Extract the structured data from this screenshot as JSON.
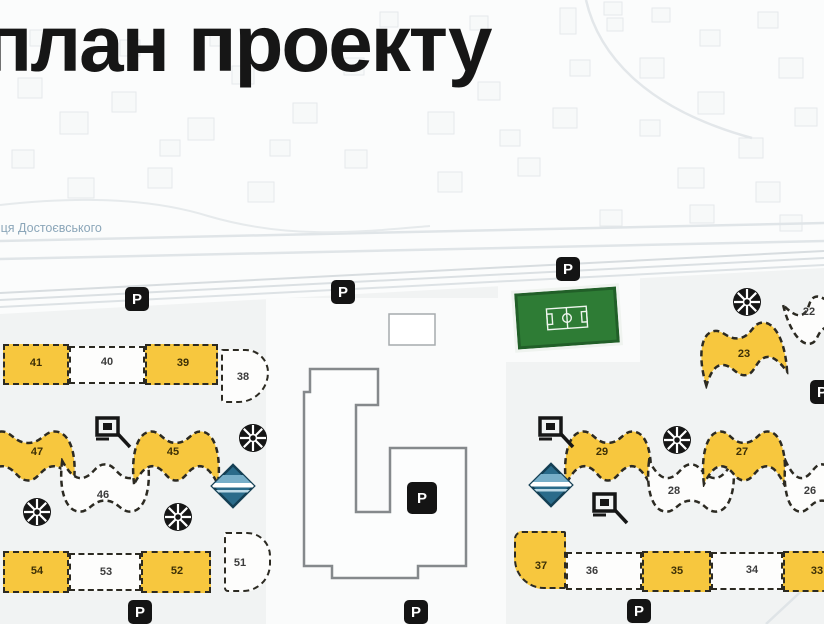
{
  "title": "план проекту",
  "street_label": "вулиця Достоєвського",
  "colors": {
    "background_top": "#fbfcfc",
    "background_site": "#f1f3f3",
    "building_yellow": "#f7c73e",
    "building_white": "#fdfdfc",
    "building_outline": "#2c2a22",
    "school_green": "#2e7c35",
    "kindergarten_blue": "#2a6b8a",
    "icon_black": "#161616",
    "central_building_stroke": "#85898c",
    "street_text": "#8ba6b9"
  },
  "buildings": [
    {
      "num": "41",
      "shape": "rect",
      "fill": "yellow",
      "x": 3,
      "y": 344,
      "w": 66,
      "h": 41,
      "nx": 36,
      "ny": 363
    },
    {
      "num": "40",
      "shape": "rect",
      "fill": "white",
      "x": 69,
      "y": 346,
      "w": 76,
      "h": 38,
      "nx": 107,
      "ny": 362
    },
    {
      "num": "39",
      "shape": "rect",
      "fill": "yellow",
      "x": 145,
      "y": 344,
      "w": 73,
      "h": 41,
      "nx": 183,
      "ny": 363
    },
    {
      "num": "38",
      "shape": "blob",
      "fill": "white",
      "x": 221,
      "y": 349,
      "w": 48,
      "h": 54,
      "radius": "2px 26px 34px 4px",
      "nx": 243,
      "ny": 377
    },
    {
      "num": "47",
      "shape": "wave",
      "fill": "yellow",
      "x": -22,
      "y": 427,
      "w": 100,
      "h": 60,
      "nx": 37,
      "ny": 452
    },
    {
      "num": "46",
      "shape": "waveDown",
      "fill": "white",
      "x": 58,
      "y": 458,
      "w": 94,
      "h": 58,
      "nx": 103,
      "ny": 495
    },
    {
      "num": "45",
      "shape": "wave",
      "fill": "yellow",
      "x": 130,
      "y": 427,
      "w": 92,
      "h": 60,
      "nx": 173,
      "ny": 452
    },
    {
      "num": "54",
      "shape": "rect",
      "fill": "yellow",
      "x": 3,
      "y": 551,
      "w": 66,
      "h": 42,
      "nx": 37,
      "ny": 571
    },
    {
      "num": "53",
      "shape": "rect",
      "fill": "white",
      "x": 69,
      "y": 553,
      "w": 72,
      "h": 38,
      "nx": 106,
      "ny": 572
    },
    {
      "num": "52",
      "shape": "rect",
      "fill": "yellow",
      "x": 141,
      "y": 551,
      "w": 70,
      "h": 42,
      "nx": 177,
      "ny": 571
    },
    {
      "num": "51",
      "shape": "blob",
      "fill": "white",
      "x": 224,
      "y": 532,
      "w": 47,
      "h": 60,
      "radius": "2px 24px 28px 4px",
      "nx": 240,
      "ny": 563
    },
    {
      "num": "22",
      "shape": "waveDown",
      "fill": "white",
      "x": 786,
      "y": 290,
      "w": 72,
      "h": 52,
      "rot": -20,
      "nx": 809,
      "ny": 312
    },
    {
      "num": "23",
      "shape": "wave",
      "fill": "yellow",
      "x": 697,
      "y": 322,
      "w": 90,
      "h": 60,
      "rot": -10,
      "nx": 744,
      "ny": 354
    },
    {
      "num": "29",
      "shape": "wave",
      "fill": "yellow",
      "x": 562,
      "y": 427,
      "w": 92,
      "h": 60,
      "nx": 602,
      "ny": 452
    },
    {
      "num": "28",
      "shape": "waveDown",
      "fill": "white",
      "x": 645,
      "y": 458,
      "w": 92,
      "h": 58,
      "nx": 674,
      "ny": 491
    },
    {
      "num": "27",
      "shape": "wave",
      "fill": "yellow",
      "x": 700,
      "y": 427,
      "w": 88,
      "h": 60,
      "nx": 742,
      "ny": 452
    },
    {
      "num": "26",
      "shape": "waveDown",
      "fill": "white",
      "x": 782,
      "y": 458,
      "w": 80,
      "h": 58,
      "nx": 810,
      "ny": 491
    },
    {
      "num": "37",
      "shape": "blob",
      "fill": "yellow",
      "x": 514,
      "y": 531,
      "w": 52,
      "h": 58,
      "radius": "8px 2px 2px 30px",
      "nx": 541,
      "ny": 566
    },
    {
      "num": "36",
      "shape": "rect",
      "fill": "white",
      "x": 566,
      "y": 552,
      "w": 76,
      "h": 38,
      "nx": 592,
      "ny": 571
    },
    {
      "num": "35",
      "shape": "rect",
      "fill": "yellow",
      "x": 642,
      "y": 551,
      "w": 69,
      "h": 41,
      "nx": 677,
      "ny": 571
    },
    {
      "num": "34",
      "shape": "rect",
      "fill": "white",
      "x": 711,
      "y": 552,
      "w": 72,
      "h": 38,
      "nx": 752,
      "ny": 570
    },
    {
      "num": "33",
      "shape": "rect",
      "fill": "yellow",
      "x": 783,
      "y": 551,
      "w": 55,
      "h": 41,
      "nx": 817,
      "ny": 571
    }
  ],
  "icons": {
    "parking_label": "P",
    "parking": [
      {
        "x": 125,
        "y": 287
      },
      {
        "x": 331,
        "y": 280
      },
      {
        "x": 556,
        "y": 257
      },
      {
        "x": 810,
        "y": 380
      },
      {
        "x": 128,
        "y": 600
      },
      {
        "x": 404,
        "y": 600
      },
      {
        "x": 627,
        "y": 599
      }
    ],
    "parking_central": {
      "x": 407,
      "y": 482,
      "w": 30,
      "h": 32
    },
    "playground": [
      {
        "cx": 37,
        "cy": 512
      },
      {
        "cx": 178,
        "cy": 517
      },
      {
        "cx": 253,
        "cy": 438
      },
      {
        "cx": 677,
        "cy": 440
      },
      {
        "cx": 747,
        "cy": 302
      }
    ],
    "sport": [
      {
        "x": 95,
        "y": 416
      },
      {
        "x": 538,
        "y": 416
      },
      {
        "x": 592,
        "y": 492
      }
    ],
    "kindergarten": [
      {
        "cx": 233,
        "cy": 486
      },
      {
        "cx": 551,
        "cy": 485
      }
    ]
  },
  "school": {
    "x": 516,
    "y": 290,
    "w": 102,
    "h": 56,
    "rot": -4
  },
  "central_building": {
    "path": "M310,369 L378,369 L378,405 L356,405 L356,512 L390,512 L390,448 L466,448 L466,566 L418,566 L418,578 L332,578 L332,566 L304,566 L304,392 L310,392 Z"
  },
  "bg": {
    "lower_poly": "0,314 824,268 824,624 0,624",
    "patches": [
      {
        "x": 266,
        "y": 298,
        "w": 240,
        "h": 326
      },
      {
        "x": 498,
        "y": 276,
        "w": 142,
        "h": 86
      }
    ],
    "outline_rect": {
      "x": 389,
      "y": 314,
      "w": 46,
      "h": 31
    },
    "roads": [
      {
        "x1": 0,
        "y1": 241,
        "x2": 824,
        "y2": 223,
        "w": 2.5,
        "c": "#e0e5e8"
      },
      {
        "x1": 0,
        "y1": 259,
        "x2": 824,
        "y2": 241,
        "w": 2.5,
        "c": "#e0e5e8"
      },
      {
        "x1": 0,
        "y1": 293,
        "x2": 824,
        "y2": 251,
        "w": 2,
        "c": "#d8dde0"
      },
      {
        "x1": 0,
        "y1": 300,
        "x2": 824,
        "y2": 258,
        "w": 2,
        "c": "#dbe0e3"
      },
      {
        "x1": 0,
        "y1": 307,
        "x2": 824,
        "y2": 265,
        "w": 2,
        "c": "#dde2e5"
      },
      {
        "x1": 766,
        "y1": 624,
        "x2": 824,
        "y2": 570,
        "w": 2.5,
        "c": "#dfe4e7"
      },
      {
        "d": "M586,0 C598,52 642,108 752,138",
        "w": 2.5,
        "c": "#e3e7ea"
      },
      {
        "d": "M0,205 C80,196 150,198 208,216 C290,240 360,232 430,226",
        "w": 2,
        "c": "#e6eaec"
      }
    ],
    "parcels": [
      [
        18,
        78,
        24,
        20
      ],
      [
        60,
        112,
        28,
        22
      ],
      [
        112,
        92,
        24,
        20
      ],
      [
        188,
        118,
        26,
        22
      ],
      [
        232,
        66,
        22,
        18
      ],
      [
        293,
        103,
        24,
        20
      ],
      [
        344,
        58,
        20,
        17
      ],
      [
        380,
        12,
        18,
        15
      ],
      [
        428,
        112,
        26,
        22
      ],
      [
        478,
        82,
        22,
        18
      ],
      [
        470,
        16,
        18,
        14
      ],
      [
        553,
        108,
        24,
        20
      ],
      [
        560,
        8,
        16,
        26
      ],
      [
        604,
        2,
        18,
        13
      ],
      [
        607,
        18,
        16,
        13
      ],
      [
        640,
        58,
        24,
        20
      ],
      [
        652,
        8,
        18,
        14
      ],
      [
        698,
        92,
        26,
        22
      ],
      [
        739,
        138,
        24,
        20
      ],
      [
        758,
        12,
        20,
        16
      ],
      [
        779,
        58,
        24,
        20
      ],
      [
        795,
        108,
        22,
        18
      ],
      [
        68,
        178,
        26,
        20
      ],
      [
        148,
        168,
        24,
        20
      ],
      [
        248,
        182,
        26,
        20
      ],
      [
        438,
        172,
        24,
        20
      ],
      [
        518,
        158,
        22,
        18
      ],
      [
        678,
        168,
        26,
        20
      ],
      [
        756,
        182,
        24,
        20
      ],
      [
        12,
        150,
        22,
        18
      ],
      [
        345,
        150,
        22,
        18
      ],
      [
        210,
        30,
        20,
        16
      ],
      [
        120,
        40,
        20,
        16
      ],
      [
        30,
        30,
        20,
        16
      ],
      [
        700,
        30,
        20,
        16
      ],
      [
        640,
        120,
        20,
        16
      ],
      [
        500,
        130,
        20,
        16
      ],
      [
        570,
        60,
        20,
        16
      ],
      [
        270,
        140,
        20,
        16
      ],
      [
        160,
        140,
        20,
        16
      ],
      [
        690,
        205,
        24,
        18
      ],
      [
        780,
        215,
        22,
        16
      ],
      [
        600,
        210,
        22,
        16
      ]
    ]
  }
}
